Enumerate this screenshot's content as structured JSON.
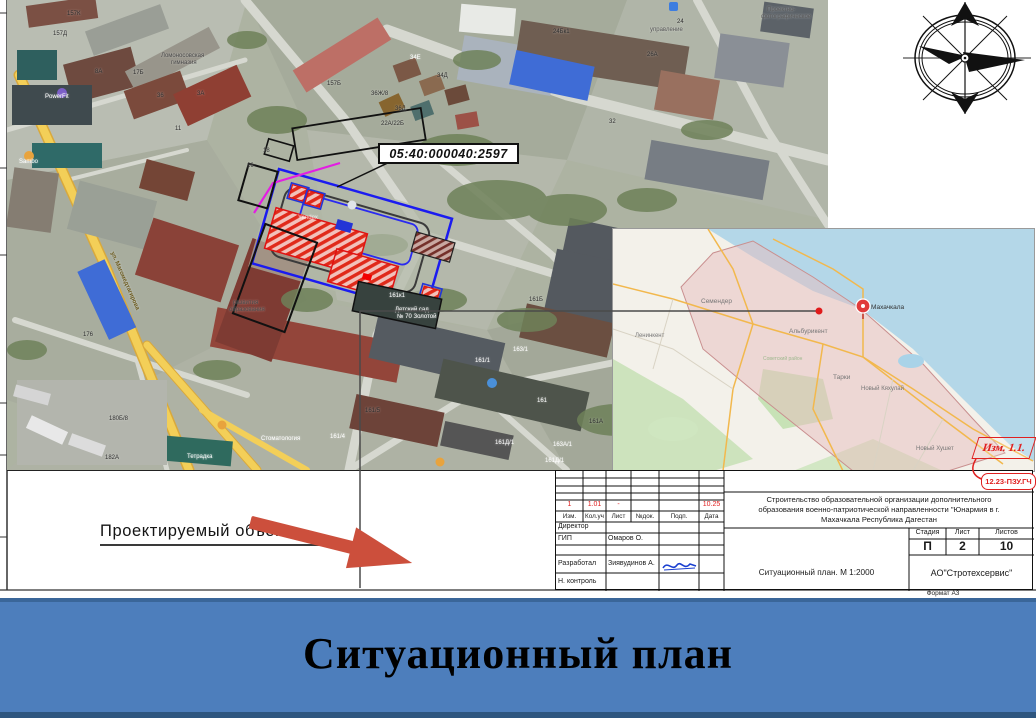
{
  "banner": {
    "title": "Ситуационный план"
  },
  "arrow_label": {
    "text": "Проектируемый объект"
  },
  "cadastral_label": {
    "text": "05:40:000040:2597"
  },
  "revision_stamp": {
    "izm": "Изм. 1.1.",
    "doc_code": "12.23-ПЗУ.ГЧ"
  },
  "title_block": {
    "project_description_lines": [
      "Строительство образовательной организации дополнительного",
      "образования военно-патриотической направленности \"Юнармия в г.",
      "Махачкала Республика Дагестан"
    ],
    "revision_row": {
      "izm": "1",
      "kol": "1.01",
      "list": "-",
      "doc": "",
      "podp": "",
      "data": "10.25"
    },
    "header_row": {
      "izm": "Изм.",
      "kol": "Кол.уч",
      "list": "Лист",
      "doc": "№док.",
      "podp": "Подп.",
      "data": "Дата"
    },
    "roles": [
      {
        "role": "Директор",
        "name": ""
      },
      {
        "role": "ГИП",
        "name": "Омаров О."
      },
      {
        "role": "",
        "name": ""
      },
      {
        "role": "Разработал",
        "name": "Зиявудинов А."
      },
      {
        "role": "Н. контроль",
        "name": ""
      }
    ],
    "sheet_info": {
      "stage_label": "Стадия",
      "sheet_label": "Лист",
      "sheets_label": "Листов",
      "stage": "П",
      "sheet": "2",
      "sheets": "10"
    },
    "drawing_title": "Ситуационный план. М 1:2000",
    "company": "АО\"Стротехсервис\"",
    "format_note": "Формат А3"
  },
  "colors": {
    "banner_blue": "#4d7ebc",
    "arrow_red": "#cc4f3c",
    "site_boundary_blue": "#1b1bf0",
    "site_magenta": "#e31de3",
    "hatch_red": "#e02a1a",
    "stamp_red": "#e02020"
  },
  "satellite_map": {
    "labels": [
      {
        "x": 62,
        "y": 14,
        "t": "157К"
      },
      {
        "x": 48,
        "y": 34,
        "t": "157Д"
      },
      {
        "x": 156,
        "y": 56,
        "t": "Ломоносовская",
        "c": "#4a4a4a"
      },
      {
        "x": 166,
        "y": 63,
        "t": "гимназия",
        "c": "#4a4a4a"
      },
      {
        "x": 40,
        "y": 97,
        "t": "PowerFit",
        "c": "#fff"
      },
      {
        "x": 90,
        "y": 72,
        "t": "8А"
      },
      {
        "x": 128,
        "y": 73,
        "t": "17Б"
      },
      {
        "x": 152,
        "y": 96,
        "t": "36"
      },
      {
        "x": 192,
        "y": 94,
        "t": "3А"
      },
      {
        "x": 170,
        "y": 129,
        "t": "11"
      },
      {
        "x": 14,
        "y": 162,
        "t": "Sambo",
        "c": "#fff"
      },
      {
        "x": 322,
        "y": 84,
        "t": "157Б"
      },
      {
        "x": 405,
        "y": 58,
        "t": "34Е",
        "c": "#fff"
      },
      {
        "x": 432,
        "y": 76,
        "t": "34Д"
      },
      {
        "x": 366,
        "y": 94,
        "t": "36Ж/8"
      },
      {
        "x": 390,
        "y": 109,
        "t": "36Д"
      },
      {
        "x": 376,
        "y": 124,
        "t": "22А/22Б"
      },
      {
        "x": 548,
        "y": 32,
        "t": "24Бк1"
      },
      {
        "x": 642,
        "y": 55,
        "t": "26А"
      },
      {
        "x": 604,
        "y": 122,
        "t": "32"
      },
      {
        "x": 672,
        "y": 22,
        "t": "24"
      },
      {
        "x": 645,
        "y": 30,
        "t": "управление",
        "c": "#5a5a5a"
      },
      {
        "x": 762,
        "y": 10,
        "t": "Проектно-",
        "c": "#5a5a5a"
      },
      {
        "x": 756,
        "y": 17,
        "t": "фотографическое",
        "c": "#5a5a5a"
      },
      {
        "x": 258,
        "y": 151,
        "t": "18"
      },
      {
        "x": 242,
        "y": 166,
        "t": "16"
      },
      {
        "x": 228,
        "y": 303,
        "t": "развития",
        "c": "#4a4a4a"
      },
      {
        "x": 224,
        "y": 310,
        "t": "образования",
        "c": "#4a4a4a"
      },
      {
        "x": 384,
        "y": 296,
        "t": "161к1",
        "c": "#fff"
      },
      {
        "x": 390,
        "y": 310,
        "t": "Детский сад",
        "c": "#fff"
      },
      {
        "x": 392,
        "y": 317,
        "t": "№ 70 Золотой",
        "c": "#fff"
      },
      {
        "x": 524,
        "y": 300,
        "t": "161Б"
      },
      {
        "x": 470,
        "y": 361,
        "t": "161/1",
        "c": "#fff"
      },
      {
        "x": 508,
        "y": 350,
        "t": "163/1",
        "c": "#fff"
      },
      {
        "x": 532,
        "y": 401,
        "t": "161",
        "c": "#fff"
      },
      {
        "x": 584,
        "y": 422,
        "t": "161А"
      },
      {
        "x": 490,
        "y": 443,
        "t": "161Д/1",
        "c": "#fff"
      },
      {
        "x": 548,
        "y": 445,
        "t": "163А/1",
        "c": "#fff"
      },
      {
        "x": 540,
        "y": 461,
        "t": "161Д/1",
        "c": "#fff"
      },
      {
        "x": 360,
        "y": 411,
        "t": "161/5"
      },
      {
        "x": 325,
        "y": 437,
        "t": "161/4",
        "c": "#fff"
      },
      {
        "x": 100,
        "y": 458,
        "t": "182А"
      },
      {
        "x": 104,
        "y": 419,
        "t": "180Б/8"
      },
      {
        "x": 182,
        "y": 457,
        "t": "Тетрадка",
        "c": "#fff"
      },
      {
        "x": 78,
        "y": 335,
        "t": "176"
      },
      {
        "x": 256,
        "y": 439,
        "t": "Стоматология",
        "c": "#fff"
      },
      {
        "x": 293,
        "y": 218,
        "t": "Yandex",
        "c": "rgba(255,255,255,0.65)"
      },
      {
        "x": 86,
        "y": 278,
        "t": "ул. Магомедтагирова",
        "c": "#6b5a1e",
        "fs": 6,
        "w": 700,
        "r": 66
      }
    ]
  },
  "regional_map": {
    "labels": [
      {
        "x": 258,
        "y": 76,
        "t": "Махачкала",
        "c": "#333",
        "fs": 6.5
      },
      {
        "x": 88,
        "y": 70,
        "t": "Семендер",
        "fs": 6.5
      },
      {
        "x": 22,
        "y": 104,
        "t": "Ленинкент"
      },
      {
        "x": 176,
        "y": 100,
        "t": "Альбурикент",
        "fs": 6.5
      },
      {
        "x": 220,
        "y": 146,
        "t": "Тарки",
        "fs": 6.5
      },
      {
        "x": 248,
        "y": 157,
        "t": "Новый Кяхулай"
      },
      {
        "x": 303,
        "y": 217,
        "t": "Новый Хушет"
      },
      {
        "x": 150,
        "y": 128,
        "t": "Советский район",
        "c": "#9fb88f",
        "fs": 5
      }
    ]
  }
}
